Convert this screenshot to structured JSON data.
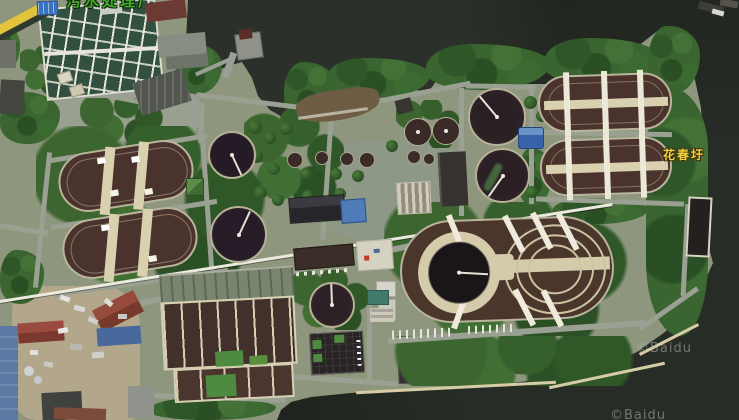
{
  "map": {
    "view": "satellite",
    "labels": {
      "top_plant_partial": "污水处理厂",
      "area_name": "花春圩"
    },
    "watermarks": [
      "©Baidu",
      "©Baidu"
    ],
    "palette": {
      "water": "#20261f",
      "land": "#8e977e",
      "vegetation": "#3a6430",
      "road": "#9aa193",
      "tank_dark": "#33242a",
      "basin_brown": "#4a332c",
      "deck_cream": "#d3cbaa",
      "label_green": "#3fae2a",
      "label_yellow": "#f2d23c",
      "watermark_gray": "#b2b2b2"
    }
  }
}
